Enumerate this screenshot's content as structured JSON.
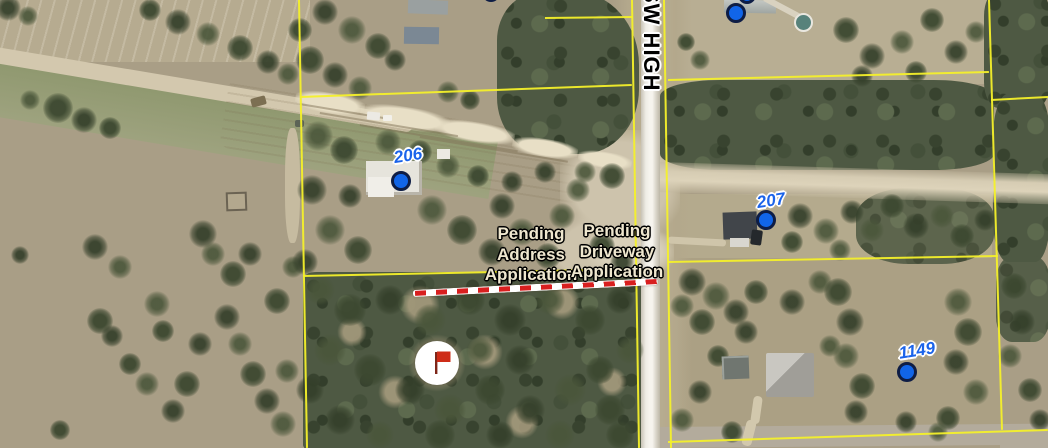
{
  "map": {
    "road_label": "SW HIGH",
    "labels": {
      "pending_address": {
        "lines": [
          "Pending",
          "Address",
          "Application"
        ],
        "x": 531,
        "y": 224
      },
      "pending_driveway": {
        "lines": [
          "Pending",
          "Driveway",
          "Application"
        ],
        "x": 617,
        "y": 221
      },
      "separator": "-"
    },
    "markers": [
      {
        "id": "top-center",
        "label": "",
        "cx": 491,
        "cy": -7,
        "small": true
      },
      {
        "id": "top-right-upper",
        "label": "",
        "cx": 747,
        "cy": -5,
        "small": true
      },
      {
        "id": "top-right",
        "label": "",
        "cx": 736,
        "cy": 13,
        "small": false
      },
      {
        "id": "206",
        "label": "206",
        "cx": 401,
        "cy": 181,
        "lx": 408,
        "ly": 156,
        "small": false
      },
      {
        "id": "207",
        "label": "207",
        "cx": 766,
        "cy": 220,
        "lx": 771,
        "ly": 201,
        "small": false
      },
      {
        "id": "1149",
        "label": "1149",
        "cx": 907,
        "cy": 372,
        "lx": 917,
        "ly": 351,
        "small": false
      }
    ],
    "flag": {
      "cx": 437,
      "cy": 363
    },
    "pending_line": {
      "x1": 413,
      "y1": 291,
      "x2": 658,
      "y2": 279
    },
    "parcel_lines": [
      [
        299,
        0,
        307,
        448
      ],
      [
        632,
        0,
        639,
        448
      ],
      [
        664,
        0,
        671,
        448
      ],
      [
        989,
        0,
        1002,
        430
      ],
      [
        300,
        97,
        632,
        85
      ],
      [
        668,
        80,
        989,
        72
      ],
      [
        991,
        100,
        1048,
        97
      ],
      [
        303,
        276,
        641,
        269
      ],
      [
        668,
        262,
        998,
        256
      ],
      [
        668,
        442,
        1048,
        430
      ],
      [
        545,
        18,
        633,
        17
      ]
    ],
    "colors": {
      "parcel_line": "#f4f02a",
      "marker_fill": "#1165e8",
      "marker_ring": "#0e1d45",
      "marker_text": "#1a63ea",
      "pending_text": "#efe7cf",
      "pending_line_red": "#d81f1f",
      "road_label_text": "#000000",
      "flag_red": "#ce2c18"
    }
  }
}
